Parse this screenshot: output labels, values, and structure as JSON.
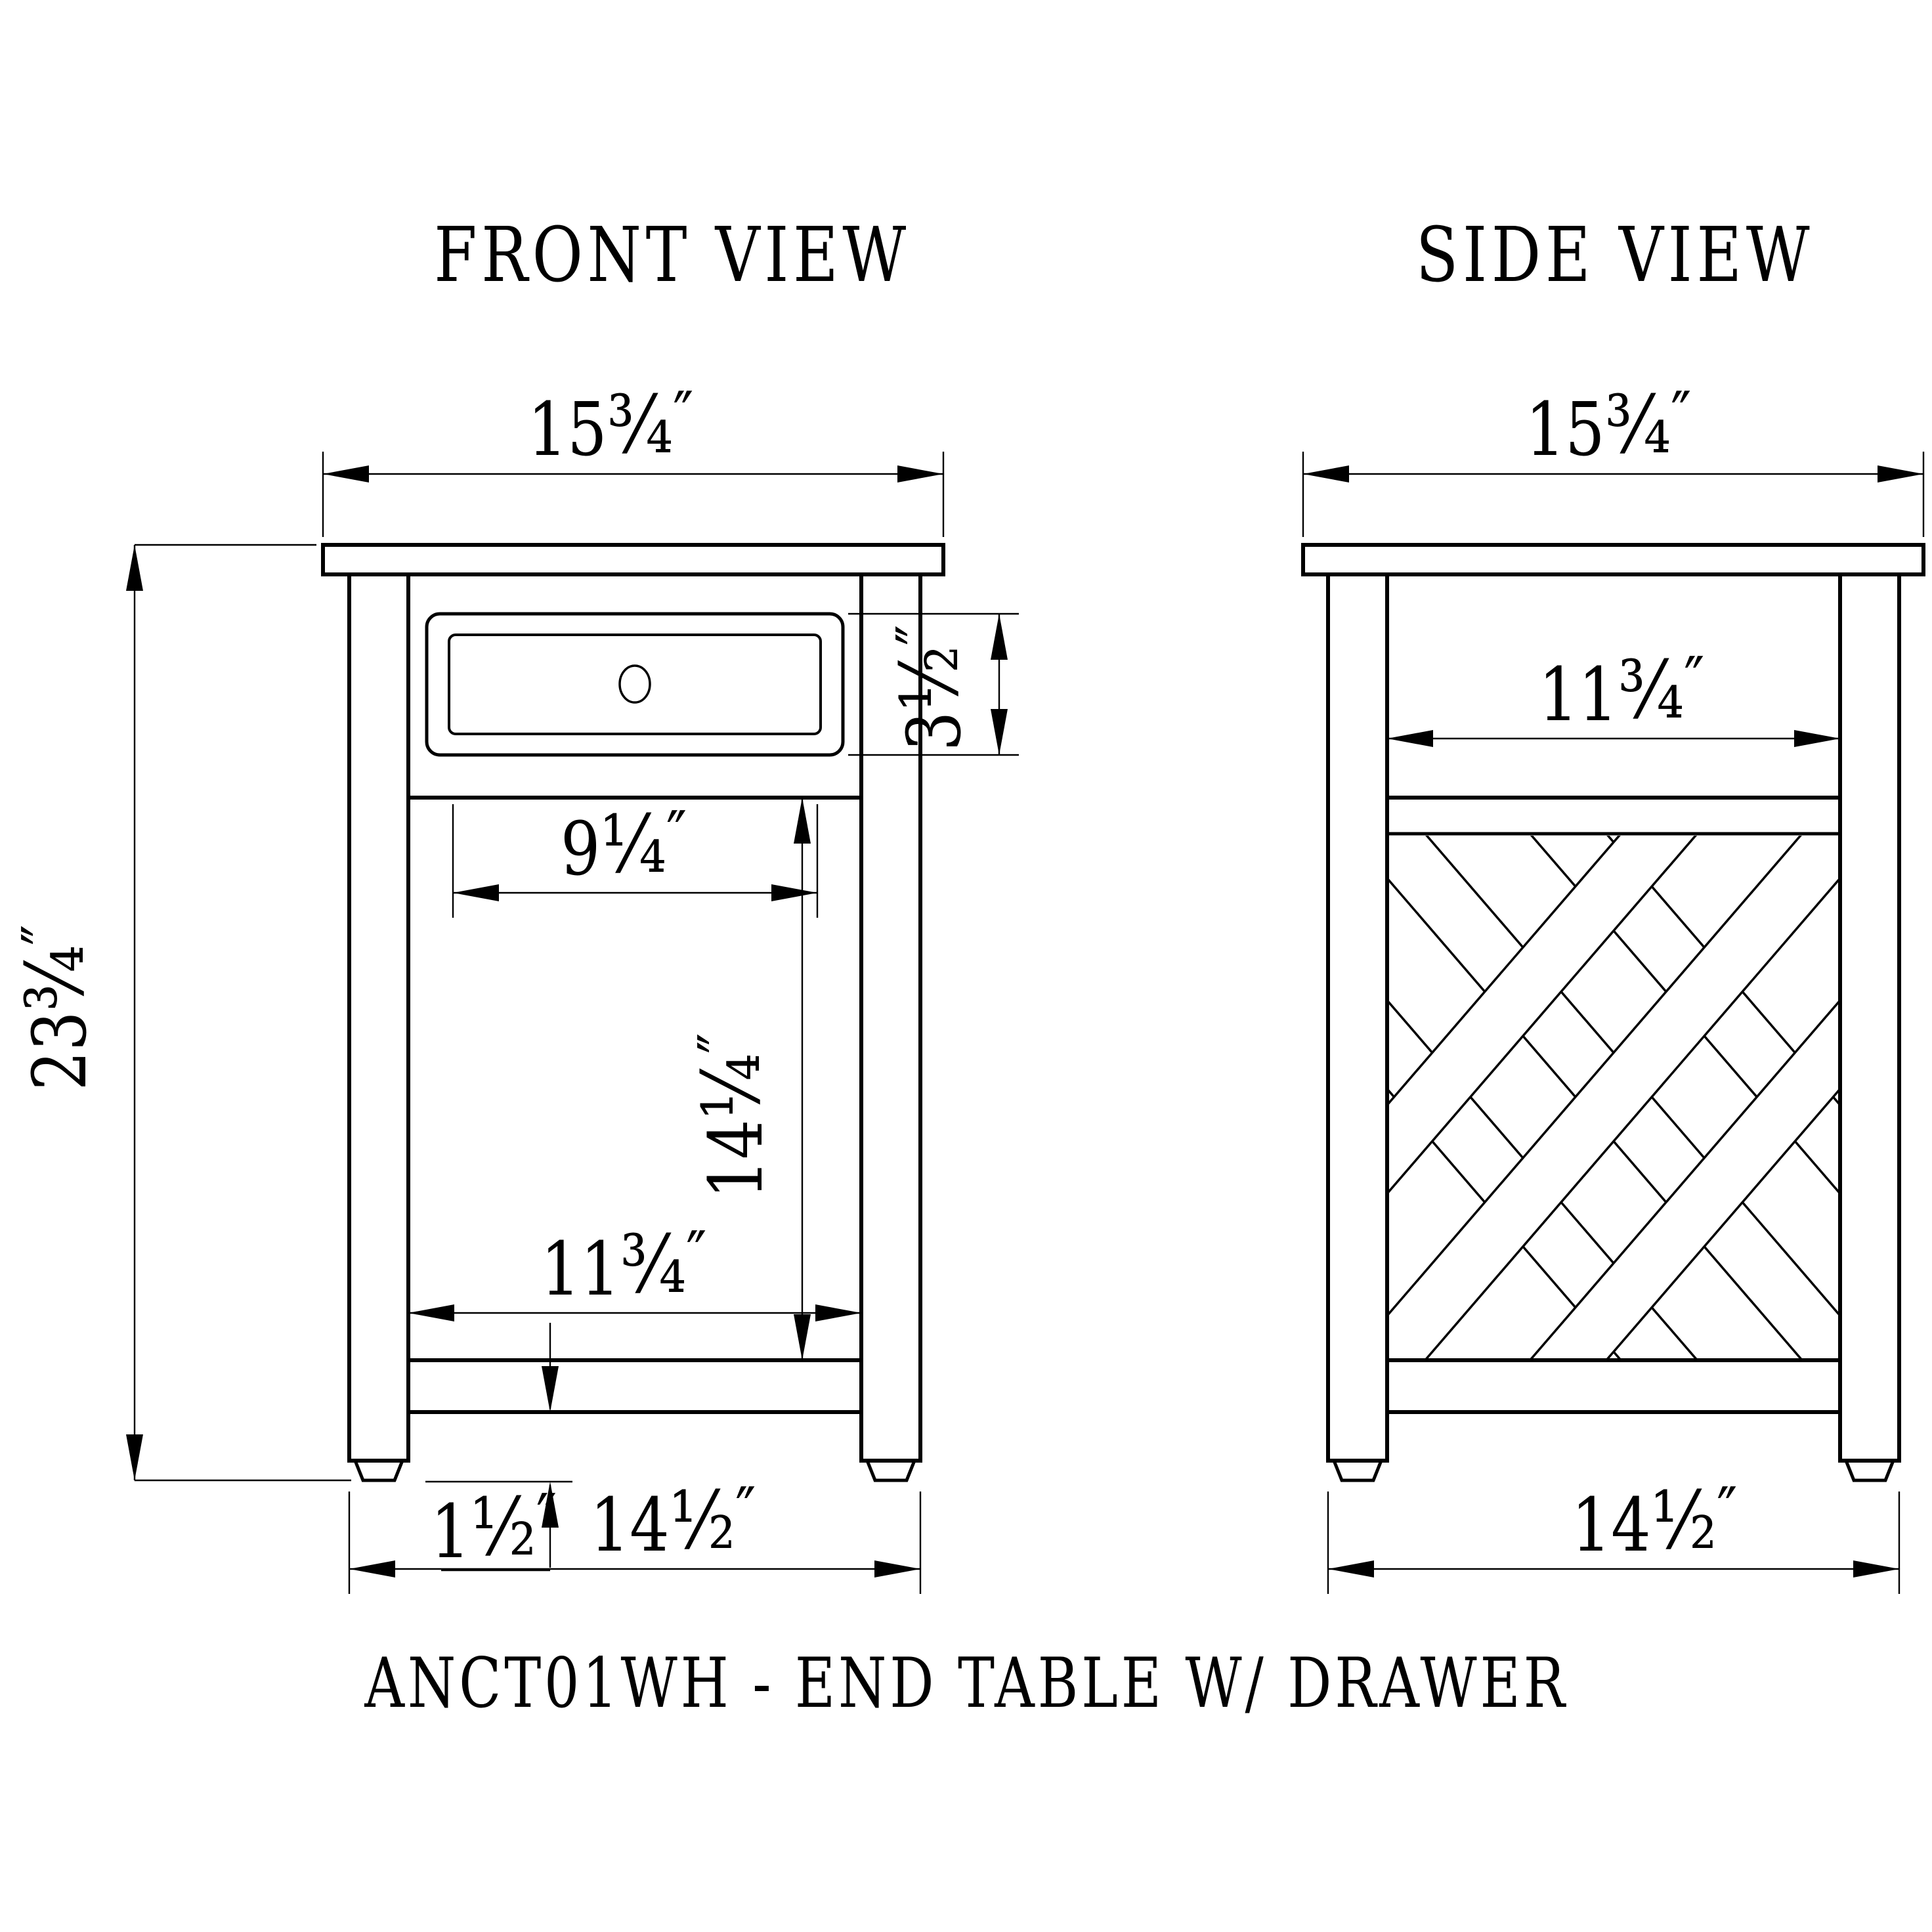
{
  "page": {
    "background_color": "#ffffff",
    "line_color": "#000000"
  },
  "caption": "ANCT01WH - END TABLE W/ DRAWER",
  "front_view": {
    "title": "FRONT VIEW",
    "dimensions": {
      "top_width": {
        "whole": "15",
        "frac": "¾",
        "unit": "″"
      },
      "overall_height": {
        "whole": "23",
        "frac": "¾",
        "unit": "″"
      },
      "drawer_height": {
        "whole": "3",
        "frac": "½",
        "unit": "″"
      },
      "drawer_width": {
        "whole": "9",
        "frac": "¼",
        "unit": "″"
      },
      "open_height": {
        "whole": "14",
        "frac": "¼",
        "unit": "″"
      },
      "inner_width": {
        "whole": "11",
        "frac": "¾",
        "unit": "″"
      },
      "stretcher_thickness": {
        "whole": "1",
        "frac": "½",
        "unit": "″"
      },
      "base_width": {
        "whole": "14",
        "frac": "½",
        "unit": "″"
      }
    }
  },
  "side_view": {
    "title": "SIDE VIEW",
    "dimensions": {
      "top_depth": {
        "whole": "15",
        "frac": "¾",
        "unit": "″"
      },
      "inner_depth": {
        "whole": "11",
        "frac": "¾",
        "unit": "″"
      },
      "base_depth": {
        "whole": "14",
        "frac": "½",
        "unit": "″"
      }
    }
  }
}
